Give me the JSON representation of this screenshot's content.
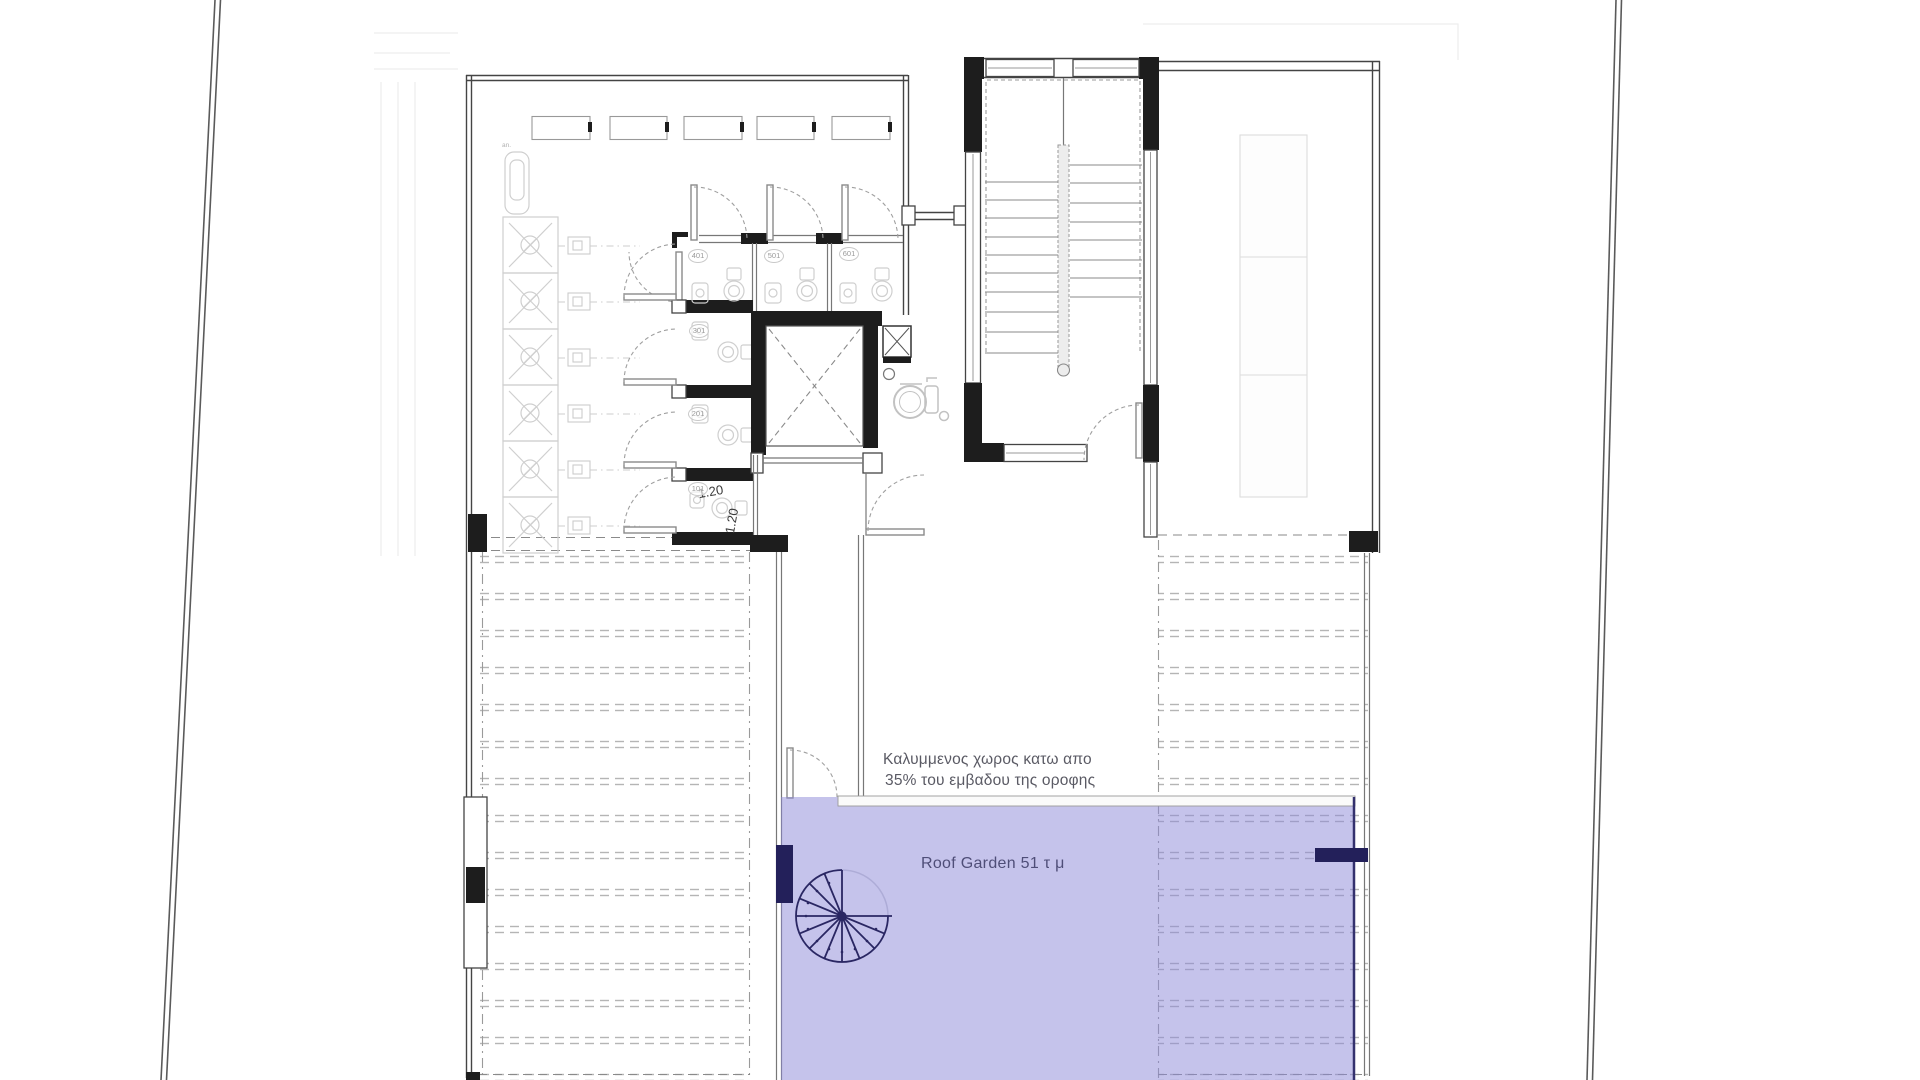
{
  "plan": {
    "title": "Roof plan",
    "notes": {
      "covered_space_line1": "Καλυμμενος χωρος κατω απο",
      "covered_space_line2": "35% του εμβαδου της οροφης"
    },
    "roof_garden": {
      "label": "Roof Garden 51 τ μ",
      "area_sqm": "51"
    },
    "dimensions": {
      "horizontal": "1.20",
      "vertical": "1.20"
    },
    "rooms": {
      "wc_labels": [
        "401",
        "501",
        "601",
        "301",
        "201",
        "101"
      ]
    },
    "equipment": {
      "tank_label": "an."
    },
    "icons": {
      "spiral_staircase": "spiral-stair-icon",
      "elevator": "elevator-x-icon",
      "wheelchair": "wheelchair-icon",
      "staircase": "staircase-icon",
      "solar_panel": "solar-panel-icon",
      "toilet": "toilet-icon"
    },
    "colors": {
      "purple-fill": "rgba(140,135,215,0.5)",
      "purple-border": "#34316e",
      "navy": "#23205a",
      "wall-black": "#1d1d1d",
      "line-dark": "#444444",
      "hatch": "#b5b5b5",
      "text-gray": "#5a5a64",
      "text-roof": "#4f4e78"
    }
  }
}
